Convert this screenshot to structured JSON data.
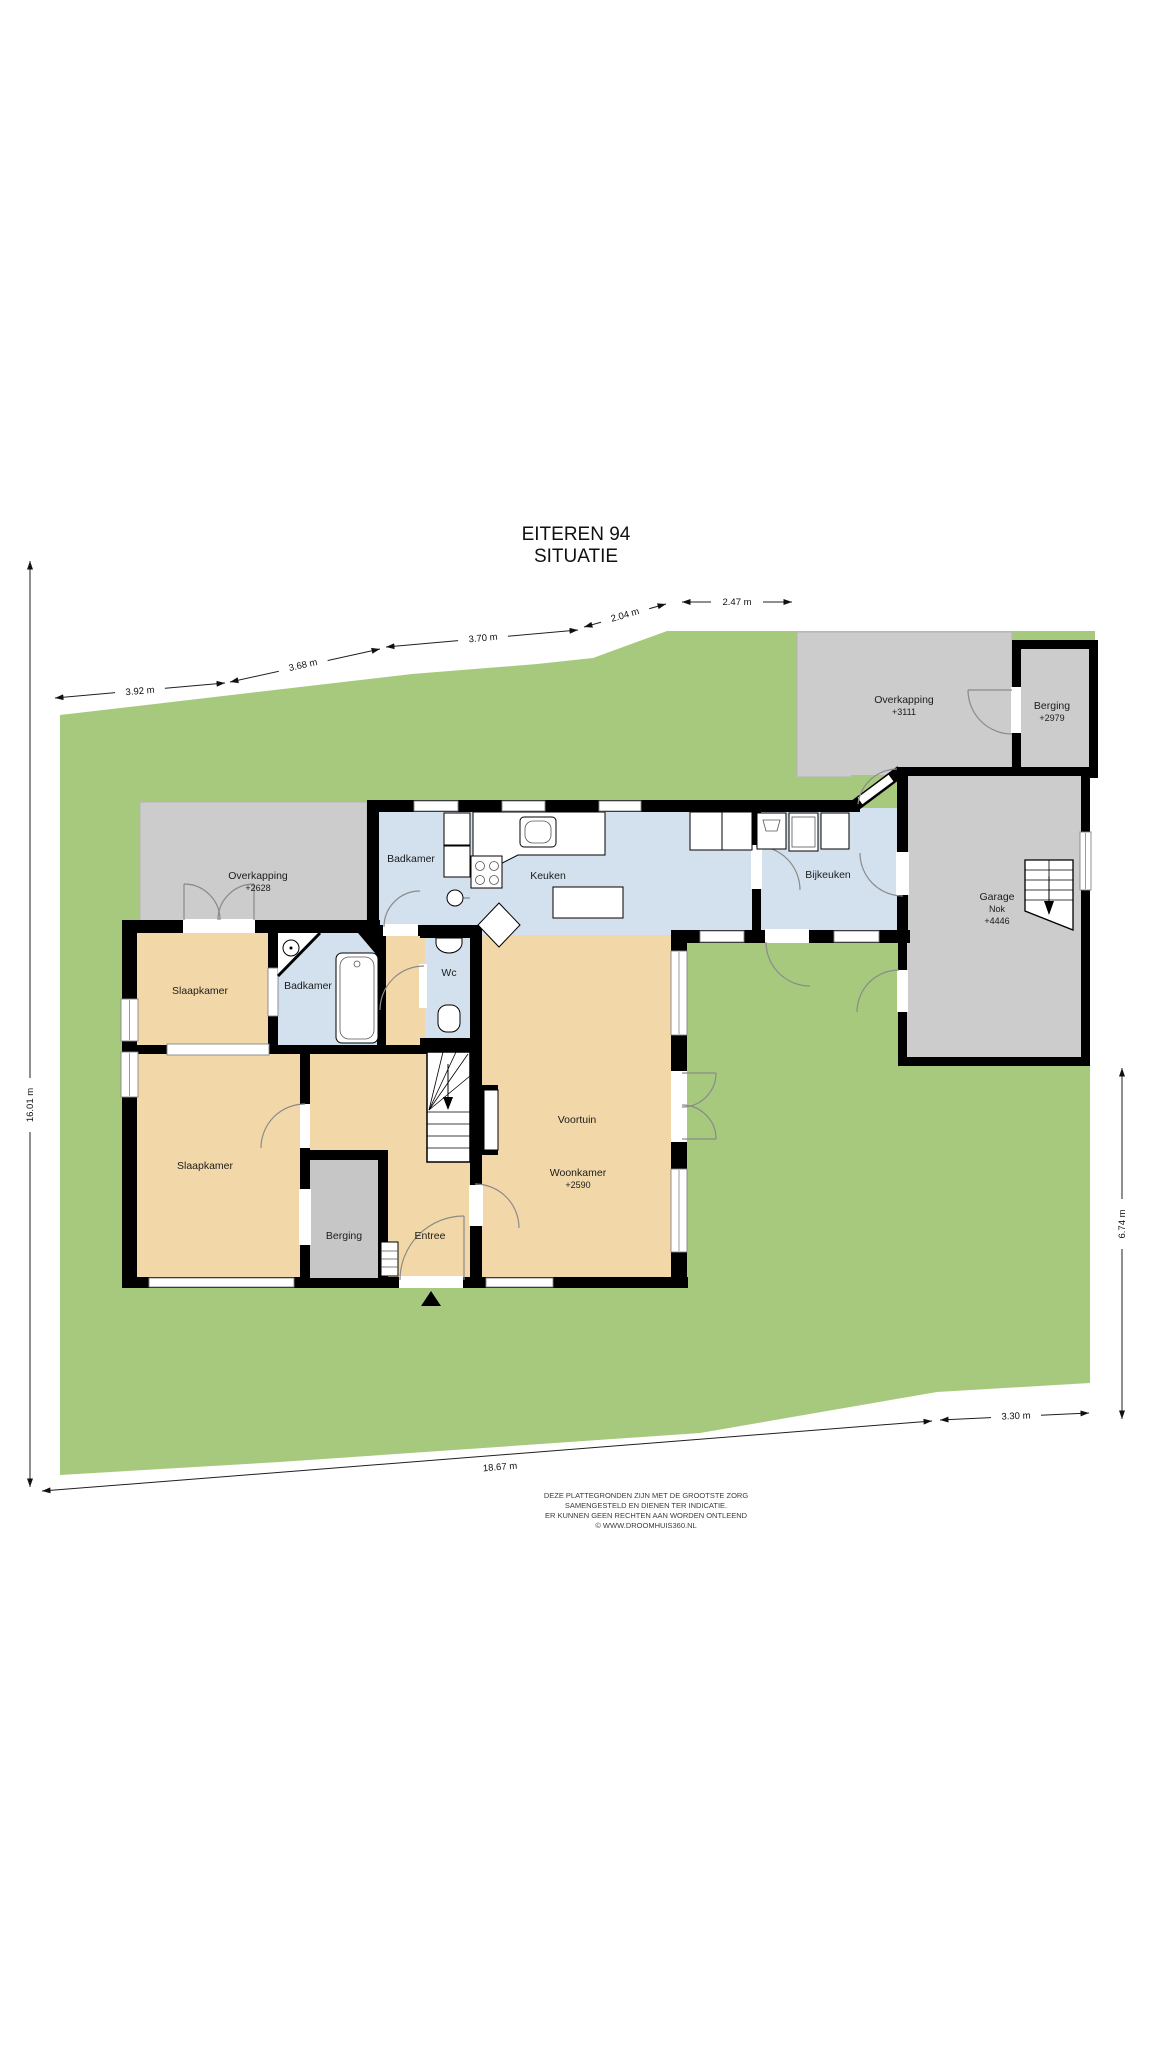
{
  "title": {
    "line1": "EITEREN 94",
    "line2": "SITUATIE"
  },
  "rooms": {
    "overkapping_right": {
      "label": "Overkapping",
      "value": "+3111"
    },
    "berging_top": {
      "label": "Berging",
      "value": "+2979"
    },
    "garage": {
      "label": "Garage",
      "sub": "Nok",
      "value": "+4446"
    },
    "overkapping_left": {
      "label": "Overkapping",
      "value": "+2628"
    },
    "badkamer_top": {
      "label": "Badkamer"
    },
    "keuken": {
      "label": "Keuken"
    },
    "bijkeuken": {
      "label": "Bijkeuken"
    },
    "slaapkamer_boven": {
      "label": "Slaapkamer"
    },
    "badkamer_links": {
      "label": "Badkamer"
    },
    "wc": {
      "label": "Wc"
    },
    "slaapkamer_onder": {
      "label": "Slaapkamer"
    },
    "berging_binnen": {
      "label": "Berging"
    },
    "entree": {
      "label": "Entree"
    },
    "voortuin": {
      "label": "Voortuin"
    },
    "woonkamer": {
      "label": "Woonkamer",
      "value": "+2590"
    }
  },
  "dimensions": {
    "top": [
      "3.92 m",
      "3.68 m",
      "3.70 m",
      "2.04 m",
      "2.47 m"
    ],
    "left": "16.01 m",
    "right": "6.74 m",
    "bottom": [
      "18.67 m",
      "3.30 m"
    ]
  },
  "disclaimer": [
    "DEZE PLATTEGRONDEN ZIJN MET DE GROOTSTE ZORG",
    "SAMENGESTELD EN DIENEN TER INDICATIE.",
    "ER KUNNEN GEEN RECHTEN AAN WORDEN ONTLEEND",
    "© WWW.DROOMHUIS360.NL"
  ],
  "colors": {
    "grass": "#a7c97d",
    "paving": "#cccccc",
    "wet_room": "#d3e0ed",
    "living": "#f2d8a8",
    "storage": "#c6c6c6",
    "wall": "#000000"
  }
}
